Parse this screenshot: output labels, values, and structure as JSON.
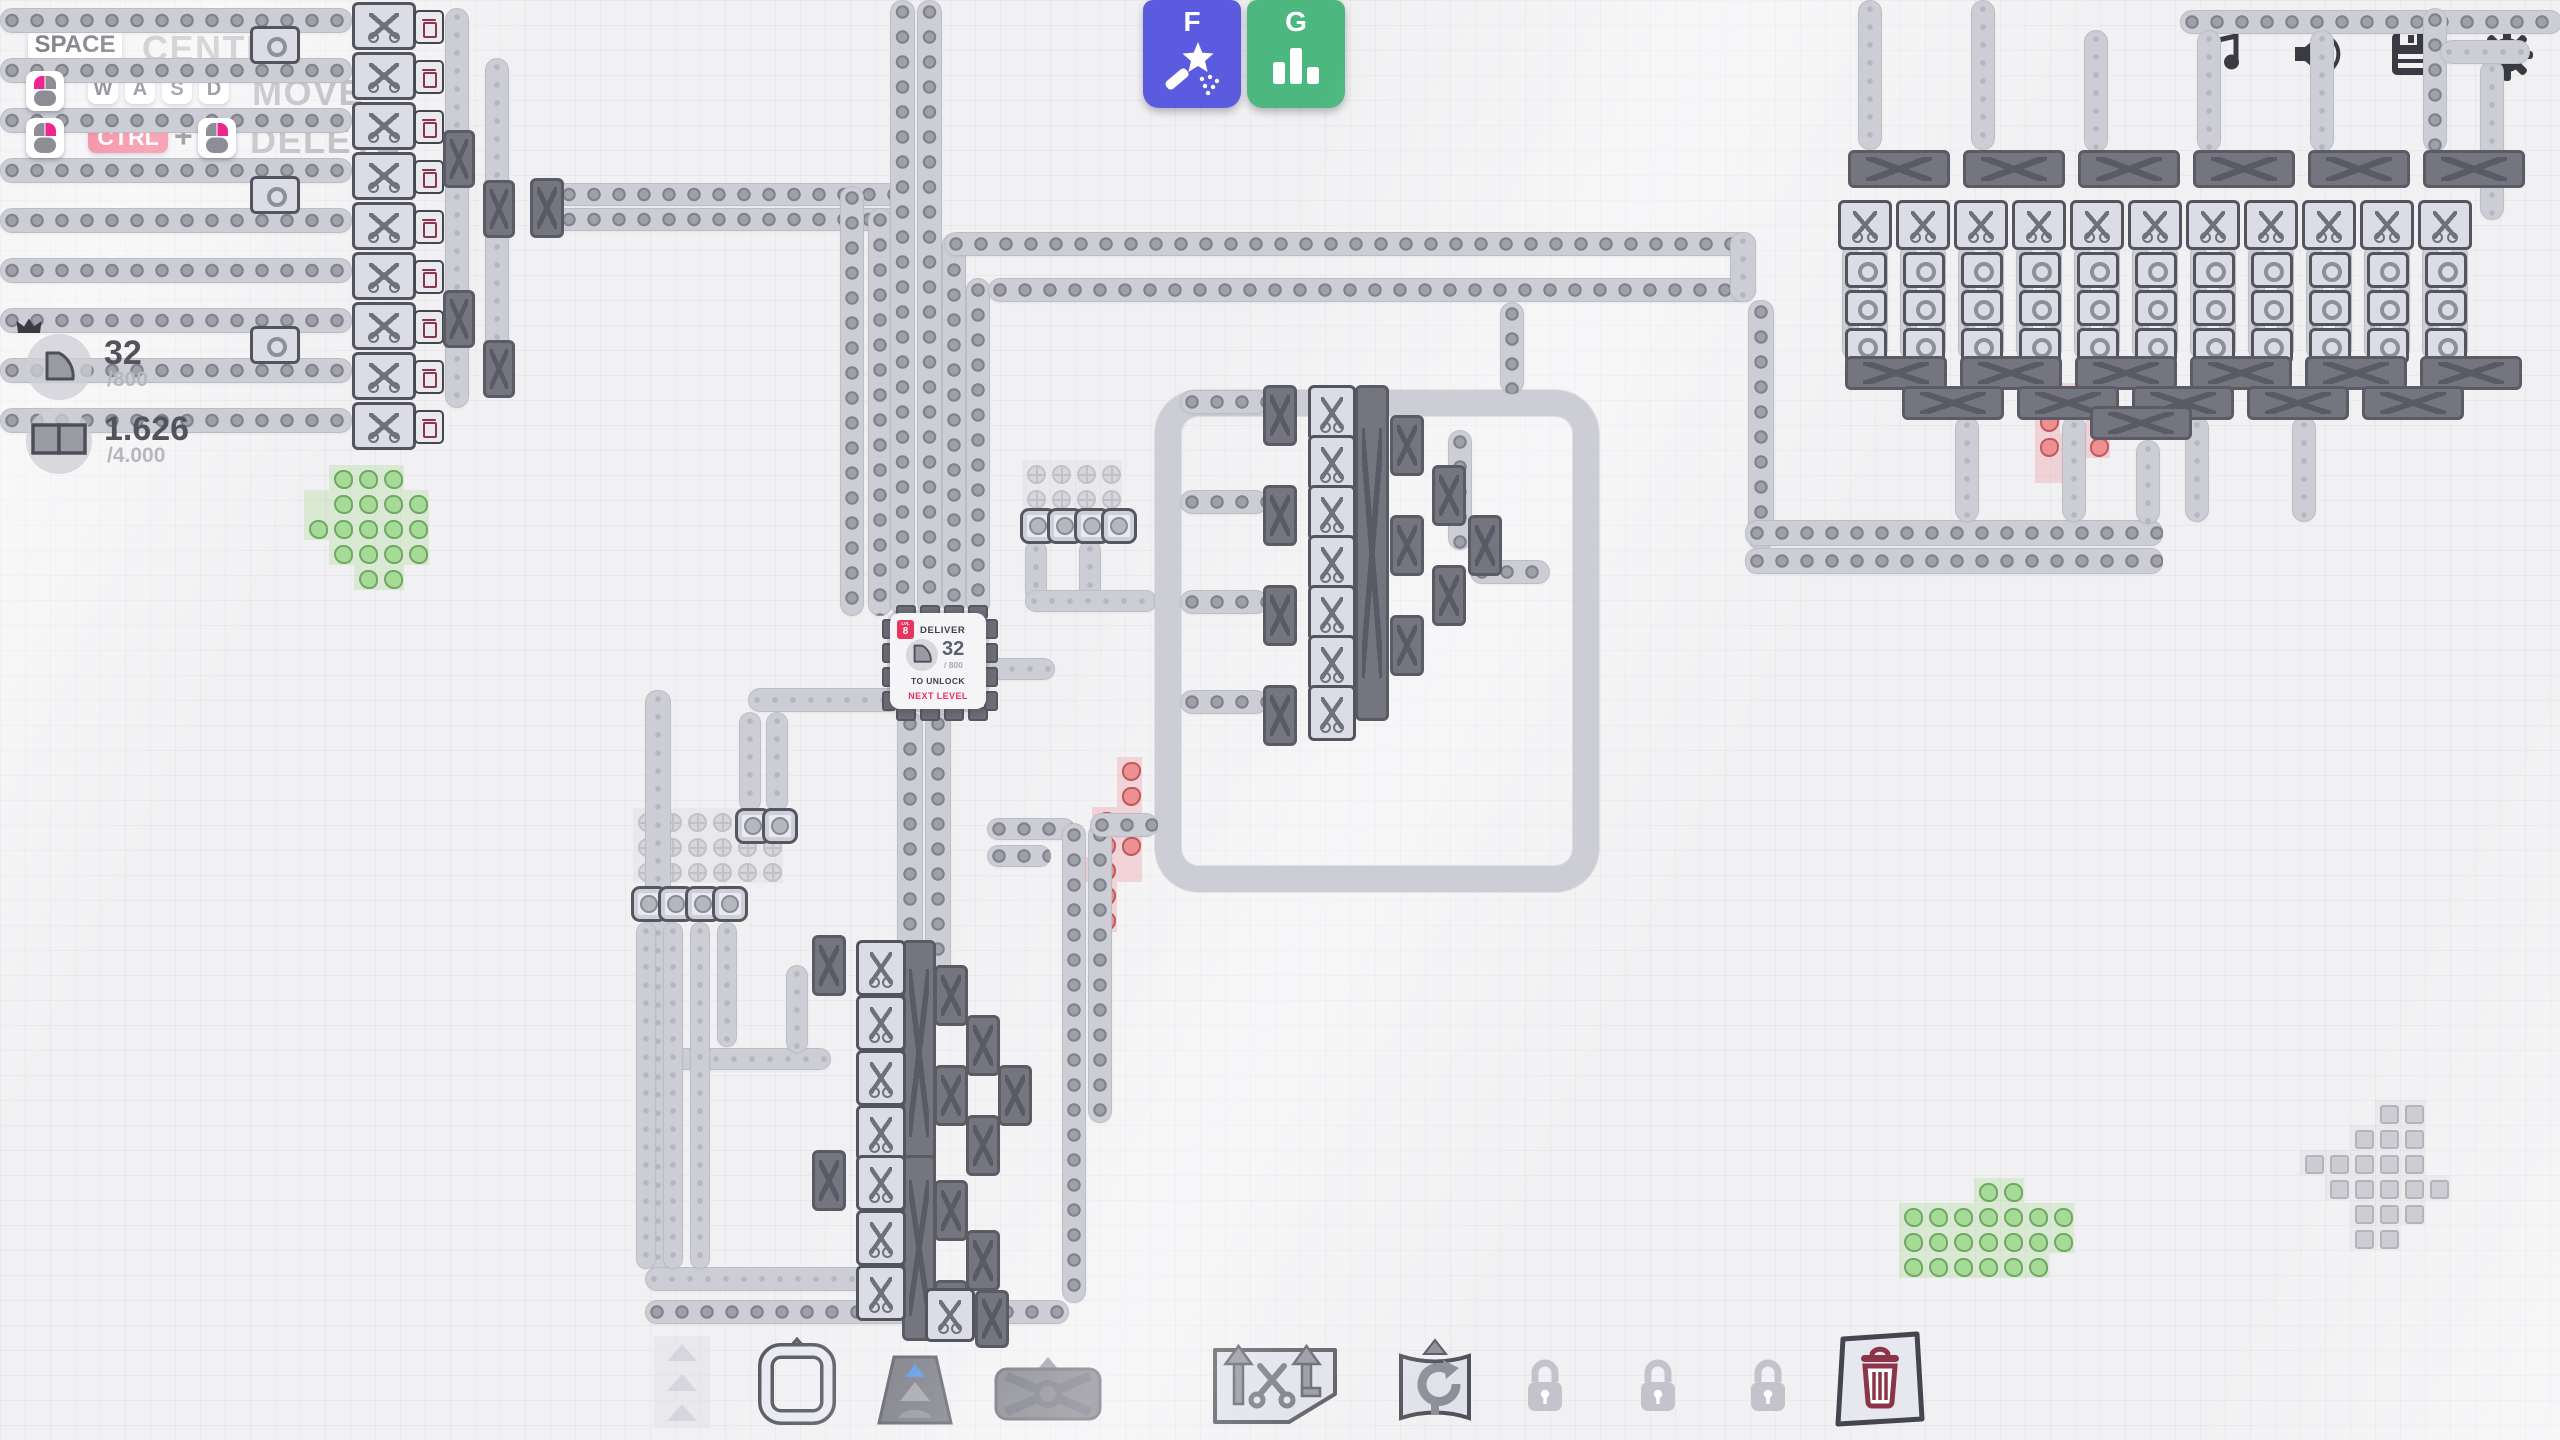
{
  "hints": {
    "space_key": "SPACE",
    "center_label": "CENTER",
    "move_keys": [
      "W",
      "A",
      "S",
      "D"
    ],
    "move_label": "MOVE",
    "ctrl_key": "CTRL",
    "plus": "+",
    "delete_label": "DELETE",
    "move_mouse_icon": "mouse-left-button-icon",
    "delete_mouse_icons": [
      "mouse-right-button-icon",
      "mouse-right-button-icon"
    ]
  },
  "pins": [
    {
      "value": "32",
      "target": "/800",
      "shape_icon": "quarter-pie-shape-icon",
      "crown_icon": "crown-icon"
    },
    {
      "value": "1.626",
      "target": "/4.000",
      "shape_icon": "two-squares-shape-icon"
    }
  ],
  "hotkeys": [
    {
      "key": "F",
      "icon": "magic-wand-icon",
      "color": "#5b5be0"
    },
    {
      "key": "G",
      "icon": "bar-chart-icon",
      "color": "#4cb87f"
    }
  ],
  "topbar_icons": [
    "music-icon",
    "volume-icon",
    "save-icon",
    "settings-gear-icon"
  ],
  "hub": {
    "level_tag": "LVL",
    "level": "8",
    "deliver_label": "DELIVER",
    "value": "32",
    "target": "/ 800",
    "unlock_line1": "TO UNLOCK",
    "unlock_line2": "NEXT LEVEL",
    "shape_icon": "quarter-pie-shape-icon"
  },
  "toolbar_slots": [
    {
      "name": "belt",
      "icon": "belt-icon",
      "dimmed": true
    },
    {
      "name": "extractor",
      "icon": "extractor-icon"
    },
    {
      "name": "tunnel",
      "icon": "tunnel-icon"
    },
    {
      "name": "balancer",
      "icon": "balancer-icon"
    },
    {
      "name": "cutter",
      "icon": "cutter-icon"
    },
    {
      "name": "rotator",
      "icon": "rotator-icon"
    },
    {
      "name": "locked-slot-1",
      "icon": "lock-icon",
      "locked": true
    },
    {
      "name": "locked-slot-2",
      "icon": "lock-icon",
      "locked": true
    },
    {
      "name": "locked-slot-3",
      "icon": "lock-icon",
      "locked": true
    },
    {
      "name": "trash",
      "icon": "trash-icon"
    }
  ],
  "colors": {
    "accent_red": "#e8345f",
    "ctrl_key_bg": "#f05070",
    "hotkey_f_bg": "#5b5be0",
    "hotkey_g_bg": "#4cb87f",
    "patch_green": "#a6db97",
    "patch_red": "#ef9090",
    "icon_dark": "#3a3a42",
    "trash_maroon": "#8e3448"
  }
}
